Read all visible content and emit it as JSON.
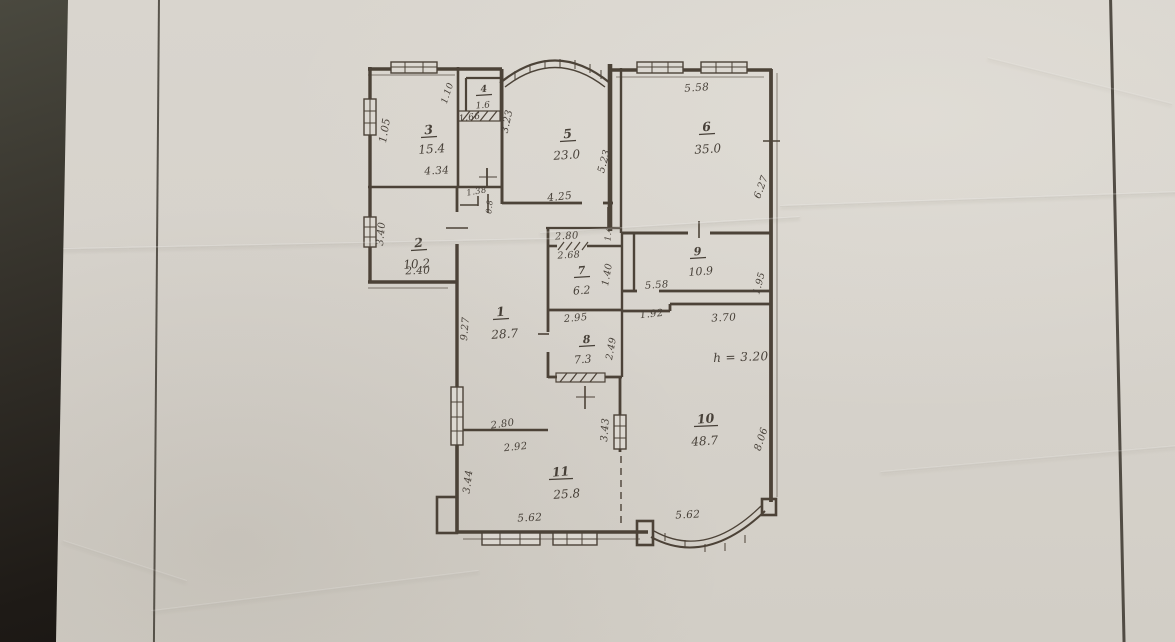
{
  "photo": {
    "background_color": "#1e1a16",
    "paper_color": "#d6d2cb",
    "ink_color": "#3c352d",
    "description_of_content": "hand-drawn floor plan sheet photographed on dark table"
  },
  "floorplan": {
    "ceiling_height_note": "h = 3.20",
    "rooms": [
      {
        "number": "1",
        "area": "28.7",
        "nx": 501,
        "ny": 316,
        "ax": 505,
        "ay": 334
      },
      {
        "number": "2",
        "area": "10.2",
        "nx": 419,
        "ny": 247,
        "ax": 417,
        "ay": 264
      },
      {
        "number": "3",
        "area": "15.4",
        "nx": 429,
        "ny": 134,
        "ax": 432,
        "ay": 149
      },
      {
        "number": "4",
        "area": "1.6",
        "nx": 484,
        "ny": 92,
        "ax": 483,
        "ay": 104,
        "nfs": 9.5,
        "afs": 9
      },
      {
        "number": "5",
        "area": "23.0",
        "nx": 568,
        "ny": 138,
        "ax": 567,
        "ay": 155
      },
      {
        "number": "6",
        "area": "35.0",
        "nx": 707,
        "ny": 131,
        "ax": 708,
        "ay": 149
      },
      {
        "number": "7",
        "area": "6.2",
        "nx": 582,
        "ny": 274,
        "ax": 582,
        "ay": 290,
        "nfs": 11,
        "afs": 11
      },
      {
        "number": "8",
        "area": "7.3",
        "nx": 587,
        "ny": 343,
        "ax": 583,
        "ay": 359,
        "nfs": 11,
        "afs": 11
      },
      {
        "number": "9",
        "area": "10.9",
        "nx": 698,
        "ny": 255,
        "ax": 701,
        "ay": 271,
        "nfs": 11,
        "afs": 11
      },
      {
        "number": "10",
        "area": "48.7",
        "nx": 706,
        "ny": 423,
        "ax": 705,
        "ay": 441
      },
      {
        "number": "11",
        "area": "25.8",
        "nx": 561,
        "ny": 476,
        "ax": 567,
        "ay": 494
      }
    ],
    "dimension_labels": [
      {
        "text": "4.34",
        "x": 437,
        "y": 174,
        "rot": -3
      },
      {
        "text": "1.05",
        "x": 388,
        "y": 131,
        "rot": -80
      },
      {
        "text": "1.10",
        "x": 450,
        "y": 94,
        "rot": -72,
        "fs": 9
      },
      {
        "text": "1.66",
        "x": 470,
        "y": 120,
        "rot": -8,
        "fs": 9
      },
      {
        "text": "3.23",
        "x": 510,
        "y": 122,
        "rot": -78,
        "fs": 10
      },
      {
        "text": "4.25",
        "x": 560,
        "y": 200,
        "rot": -6
      },
      {
        "text": "5.23",
        "x": 607,
        "y": 162,
        "rot": -75,
        "fs": 10
      },
      {
        "text": "5.58",
        "x": 697,
        "y": 91,
        "rot": -4
      },
      {
        "text": "6.27",
        "x": 764,
        "y": 188,
        "rot": -70,
        "fs": 10
      },
      {
        "text": "3.40",
        "x": 384,
        "y": 234,
        "rot": -85,
        "fs": 10
      },
      {
        "text": "2.40",
        "x": 418,
        "y": 274,
        "rot": -2
      },
      {
        "text": "1.38",
        "x": 477,
        "y": 194,
        "rot": -10,
        "fs": 8.5
      },
      {
        "text": "0.8",
        "x": 492,
        "y": 207,
        "rot": -85,
        "fs": 8
      },
      {
        "text": "2.80",
        "x": 567,
        "y": 239,
        "rot": -3,
        "fs": 10
      },
      {
        "text": "2.68",
        "x": 569,
        "y": 258,
        "rot": -3,
        "fs": 9.5
      },
      {
        "text": "1.4",
        "x": 611,
        "y": 234,
        "rot": -85,
        "fs": 8.5
      },
      {
        "text": "1.40",
        "x": 610,
        "y": 275,
        "rot": -80,
        "fs": 9.5
      },
      {
        "text": "5.58",
        "x": 657,
        "y": 288,
        "rot": -4,
        "fs": 10
      },
      {
        "text": "1.95",
        "x": 762,
        "y": 284,
        "rot": -75,
        "fs": 9.5
      },
      {
        "text": "2.95",
        "x": 576,
        "y": 321,
        "rot": -5,
        "fs": 10
      },
      {
        "text": "2.49",
        "x": 614,
        "y": 349,
        "rot": -80,
        "fs": 9.5
      },
      {
        "text": "1.92",
        "x": 652,
        "y": 317,
        "rot": -6,
        "fs": 10
      },
      {
        "text": "3.70",
        "x": 724,
        "y": 321,
        "rot": -3
      },
      {
        "text": "h = 3.20",
        "x": 741,
        "y": 361,
        "rot": -2,
        "fs": 12
      },
      {
        "text": "9.27",
        "x": 468,
        "y": 329,
        "rot": -85,
        "fs": 10
      },
      {
        "text": "2.80",
        "x": 503,
        "y": 427,
        "rot": -8,
        "fs": 10
      },
      {
        "text": "2.92",
        "x": 516,
        "y": 450,
        "rot": -6,
        "fs": 10
      },
      {
        "text": "3.44",
        "x": 471,
        "y": 482,
        "rot": -83,
        "fs": 10
      },
      {
        "text": "3.43",
        "x": 608,
        "y": 430,
        "rot": -86,
        "fs": 10
      },
      {
        "text": "5.62",
        "x": 530,
        "y": 521,
        "rot": -3
      },
      {
        "text": "5.62",
        "x": 688,
        "y": 518,
        "rot": -3
      },
      {
        "text": "8.06",
        "x": 764,
        "y": 440,
        "rot": -72,
        "fs": 10
      }
    ]
  }
}
